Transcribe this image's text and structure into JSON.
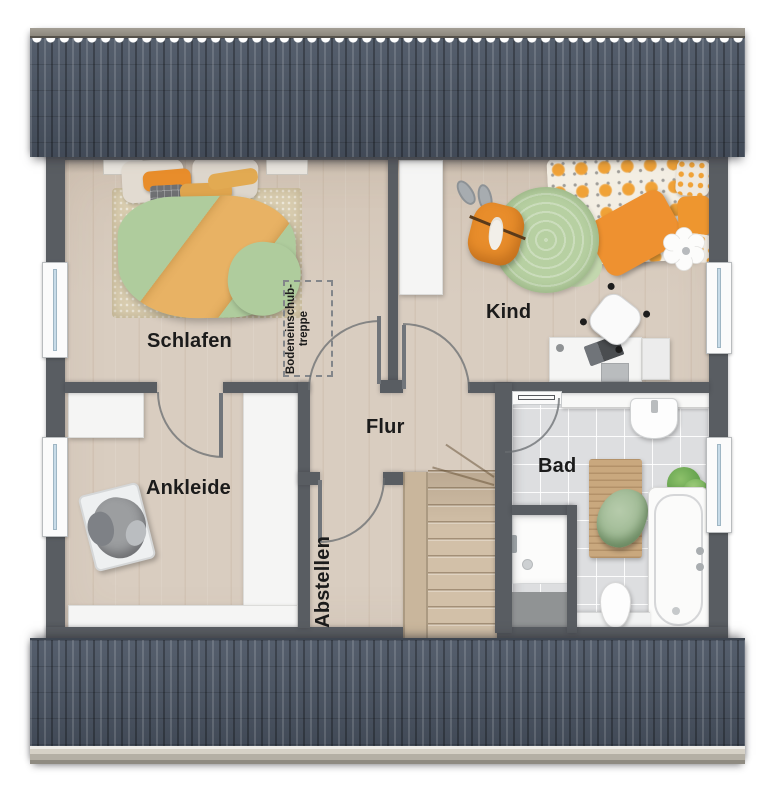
{
  "rooms": {
    "schlafen": {
      "label": "Schlafen"
    },
    "kind": {
      "label": "Kind"
    },
    "ankleide": {
      "label": "Ankleide"
    },
    "flur": {
      "label": "Flur"
    },
    "abstellen": {
      "label": "Abstellen"
    },
    "bad": {
      "label": "Bad"
    }
  },
  "annotations": {
    "attic_stairs": {
      "line1": "Bodeneinschub-",
      "line2": "treppe"
    }
  },
  "colors": {
    "roof": "#4c5665",
    "ridge_cap": "#968f83",
    "gutter": "#b4afa4",
    "wall": "#595d62",
    "floor_wood": "#d9cdc0",
    "floor_tile": "#dddee0",
    "stair_wood": "#d2c0a8",
    "banister_wood": "#c9b69c",
    "rug_beige": "#d9cdb0",
    "rug_green": "#b7d0a2",
    "duvet_green": "#afcc9d",
    "duvet_orange": "#e8b264",
    "accent_orange": "#e88d2b",
    "furniture_white": "#f5f5f4",
    "label_text": "#1b1b1b"
  }
}
